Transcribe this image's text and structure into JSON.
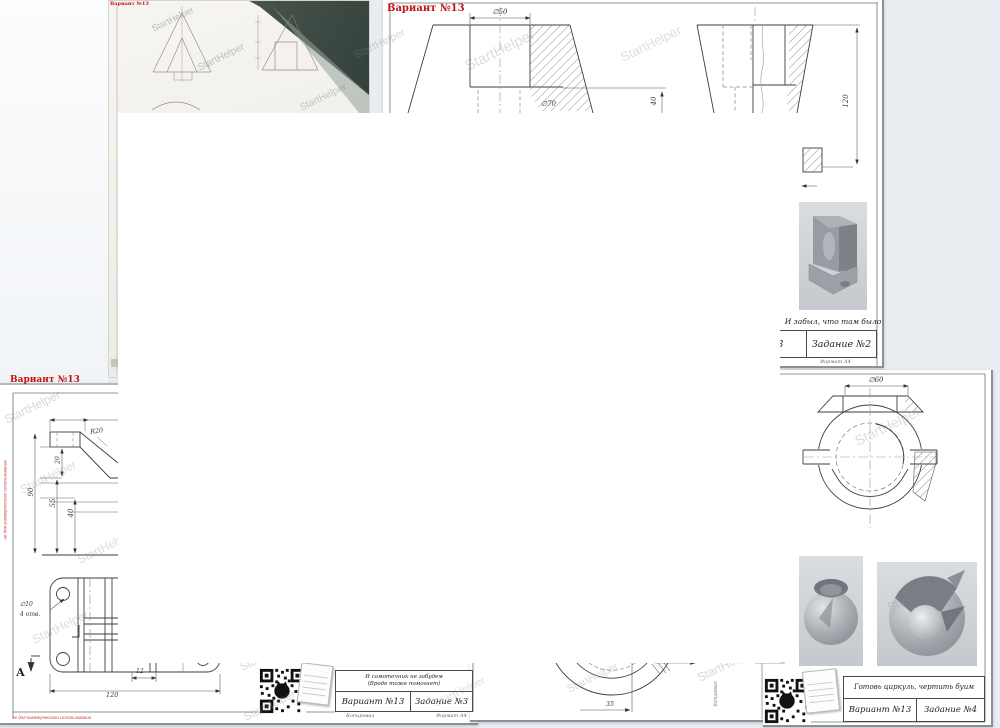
{
  "page": {
    "background": "#e9edf2"
  },
  "watermark": {
    "text": "StartHelper",
    "color": "#8a98a6"
  },
  "photo": {
    "variant_label": "Вариант №13"
  },
  "sheet2": {
    "variant_label": "Вариант №13",
    "dim_d50": "∅50",
    "dim_d70": "∅70",
    "dim_40": "40",
    "dim_120": "120",
    "note": "И забыл, что там было",
    "block_variant": "Вариант №13",
    "block_task": "Задание №2",
    "format_label": "Формат А4"
  },
  "sheet3": {
    "variant_label": "Вариант №13",
    "dim_r20": "R20",
    "dim_90": "90",
    "dim_20": "20",
    "dim_55": "55",
    "dim_40": "40",
    "dim_d10": "∅10",
    "dim_holes": "4 отв.",
    "section_a": "А",
    "dim_12": "12",
    "dim_120": "120",
    "note_line1": "И самоточник не забудем",
    "note_line2": "(Вроде тоже помогает)",
    "block_variant": "Вариант №13",
    "block_task": "Задание №3",
    "copied_label": "Копировал",
    "format_label": "Формат А4",
    "side_note": "не для коммерческого использования",
    "bottom_note": "не для коммерческого использования"
  },
  "sheet5": {
    "dim_35": "35",
    "copied_label": "Копировал"
  },
  "sheet4": {
    "dim_d60": "∅60",
    "note": "Готовь циркуль, чертить буим",
    "block_variant": "Вариант №13",
    "block_task": "Задание №4"
  }
}
